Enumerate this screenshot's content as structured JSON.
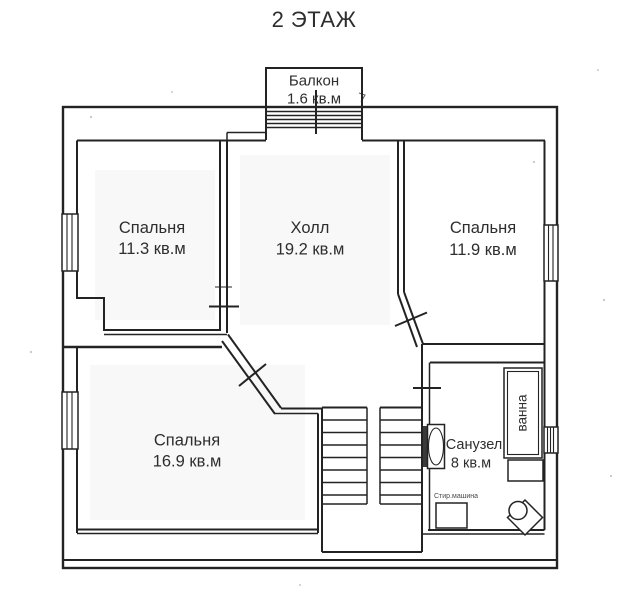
{
  "title": "2 ЭТАЖ",
  "plan": {
    "colors": {
      "line": "#232323",
      "background": "#ffffff",
      "text": "#2e2e2e"
    },
    "balcony": {
      "name": "Балкон",
      "area": "1.6 кв.м"
    },
    "rooms": [
      {
        "key": "bedroom-top-left",
        "name": "Спальня",
        "area": "11.3 кв.м"
      },
      {
        "key": "hall",
        "name": "Холл",
        "area": "19.2 кв.м"
      },
      {
        "key": "bedroom-top-right",
        "name": "Спальня",
        "area": "11.9 кв.м"
      },
      {
        "key": "bedroom-bottom-left",
        "name": "Спальня",
        "area": "16.9 кв.м"
      },
      {
        "key": "bathroom",
        "name": "Санузел",
        "area": "8 кв.м"
      }
    ],
    "fixtures": {
      "bath": "ванна",
      "washing_machine": "Стир.машина"
    }
  }
}
